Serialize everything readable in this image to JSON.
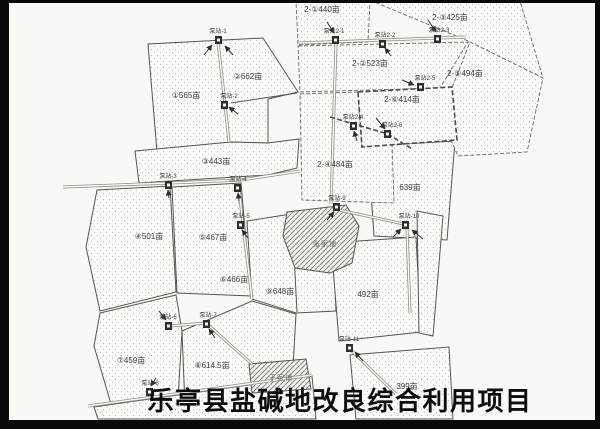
{
  "title": "乐亭县盐碱地改良综合利用项目",
  "map": {
    "unit": "亩",
    "palette": {
      "background": "#f8f8f4",
      "parcel_outline": "#55544e",
      "frame": "#0a0a0a",
      "title_color": "#0e0e0e"
    },
    "parcels": [
      {
        "label": "①565亩"
      },
      {
        "label": "②662亩"
      },
      {
        "label": "③443亩"
      },
      {
        "label": "④501亩"
      },
      {
        "label": "⑤467亩"
      },
      {
        "label": "⑥466亩"
      },
      {
        "label": "⑦459亩"
      },
      {
        "label": "⑧614.5亩"
      },
      {
        "label": "⑨648亩"
      },
      {
        "label": "2-①440亩"
      },
      {
        "label": "2-②523亩"
      },
      {
        "label": "2-③425亩"
      },
      {
        "label": "2-④484亩"
      },
      {
        "label": "2-⑤494亩"
      },
      {
        "label": "2-⑥414亩"
      },
      {
        "label": "639亩"
      },
      {
        "label": "492亩"
      },
      {
        "label": "399亩"
      }
    ],
    "pumps": [
      {
        "label": "泵站-1"
      },
      {
        "label": "泵站-2"
      },
      {
        "label": "泵站-3"
      },
      {
        "label": "泵站-4"
      },
      {
        "label": "泵站-5"
      },
      {
        "label": "泵站-6"
      },
      {
        "label": "泵站-7"
      },
      {
        "label": "泵站-8"
      },
      {
        "label": "泵站-9"
      },
      {
        "label": "泵站-10"
      },
      {
        "label": "泵站-11"
      },
      {
        "label": "泵站2-1"
      },
      {
        "label": "泵站2-2"
      },
      {
        "label": "泵站2-3"
      },
      {
        "label": "泵站2-4"
      },
      {
        "label": "泵站2-5"
      },
      {
        "label": "泵站2-6"
      }
    ],
    "villages": [
      {
        "label": "张家铺"
      },
      {
        "label": "于家铺"
      }
    ]
  }
}
